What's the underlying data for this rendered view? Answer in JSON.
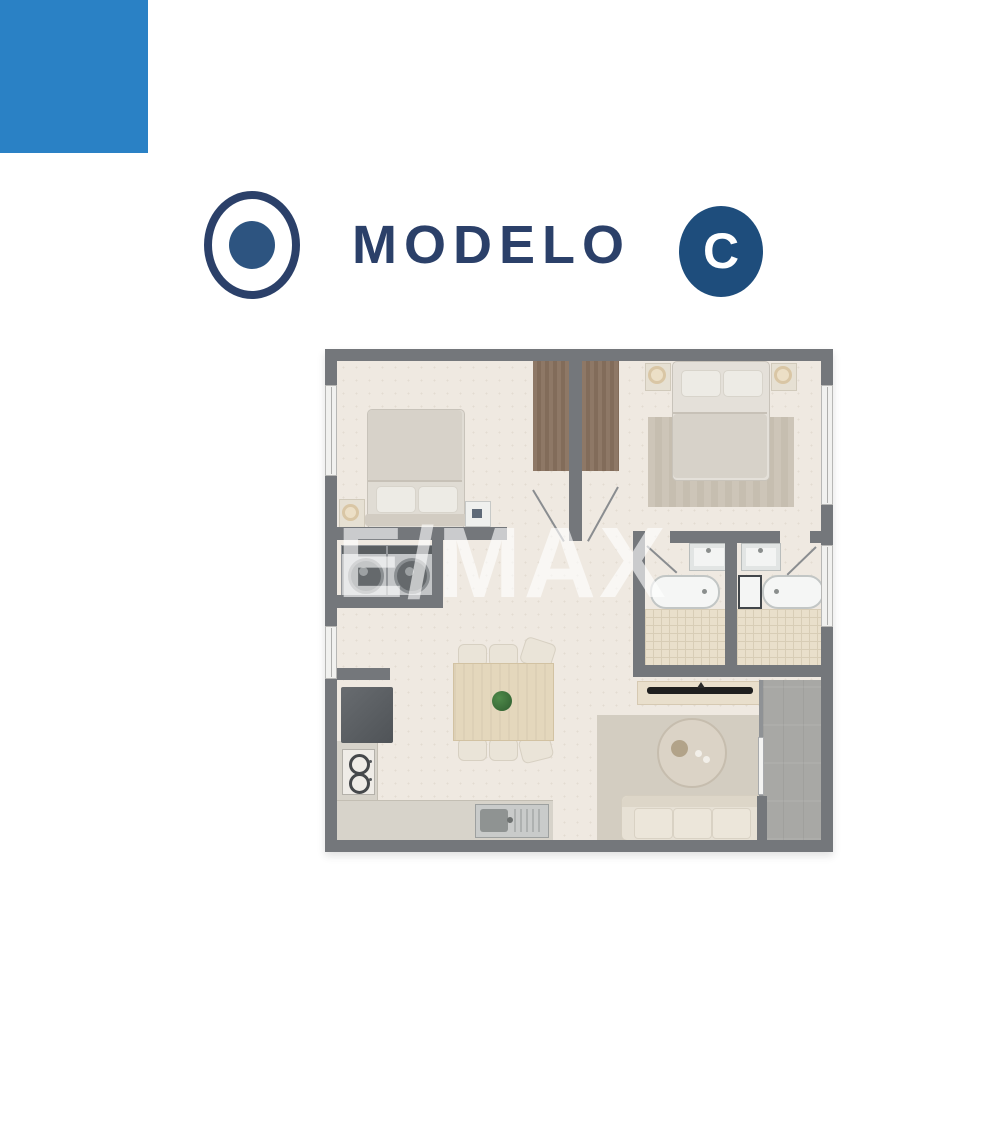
{
  "header": {
    "title": "MODELO",
    "badge_label": "C",
    "logo_icon": "circle-dot-icon"
  },
  "brand": {
    "accent_blue": "#2a81c5",
    "navy_text": "#2b4069",
    "badge_navy": "#1e4d7c"
  },
  "floor_plan": {
    "watermark": "E/MAX",
    "rooms": [
      "bedroom-1",
      "bedroom-2",
      "closets",
      "hallway",
      "bathroom-1",
      "bathroom-2",
      "laundry",
      "kitchen",
      "dining-area",
      "living-room",
      "balcony"
    ],
    "colors": {
      "walls": "#74777b",
      "floor": "#efe9e1",
      "closet_wood": "#8b7562",
      "bathroom_tile": "#e7ddc9",
      "balcony_concrete": "#a8a8a5"
    }
  }
}
